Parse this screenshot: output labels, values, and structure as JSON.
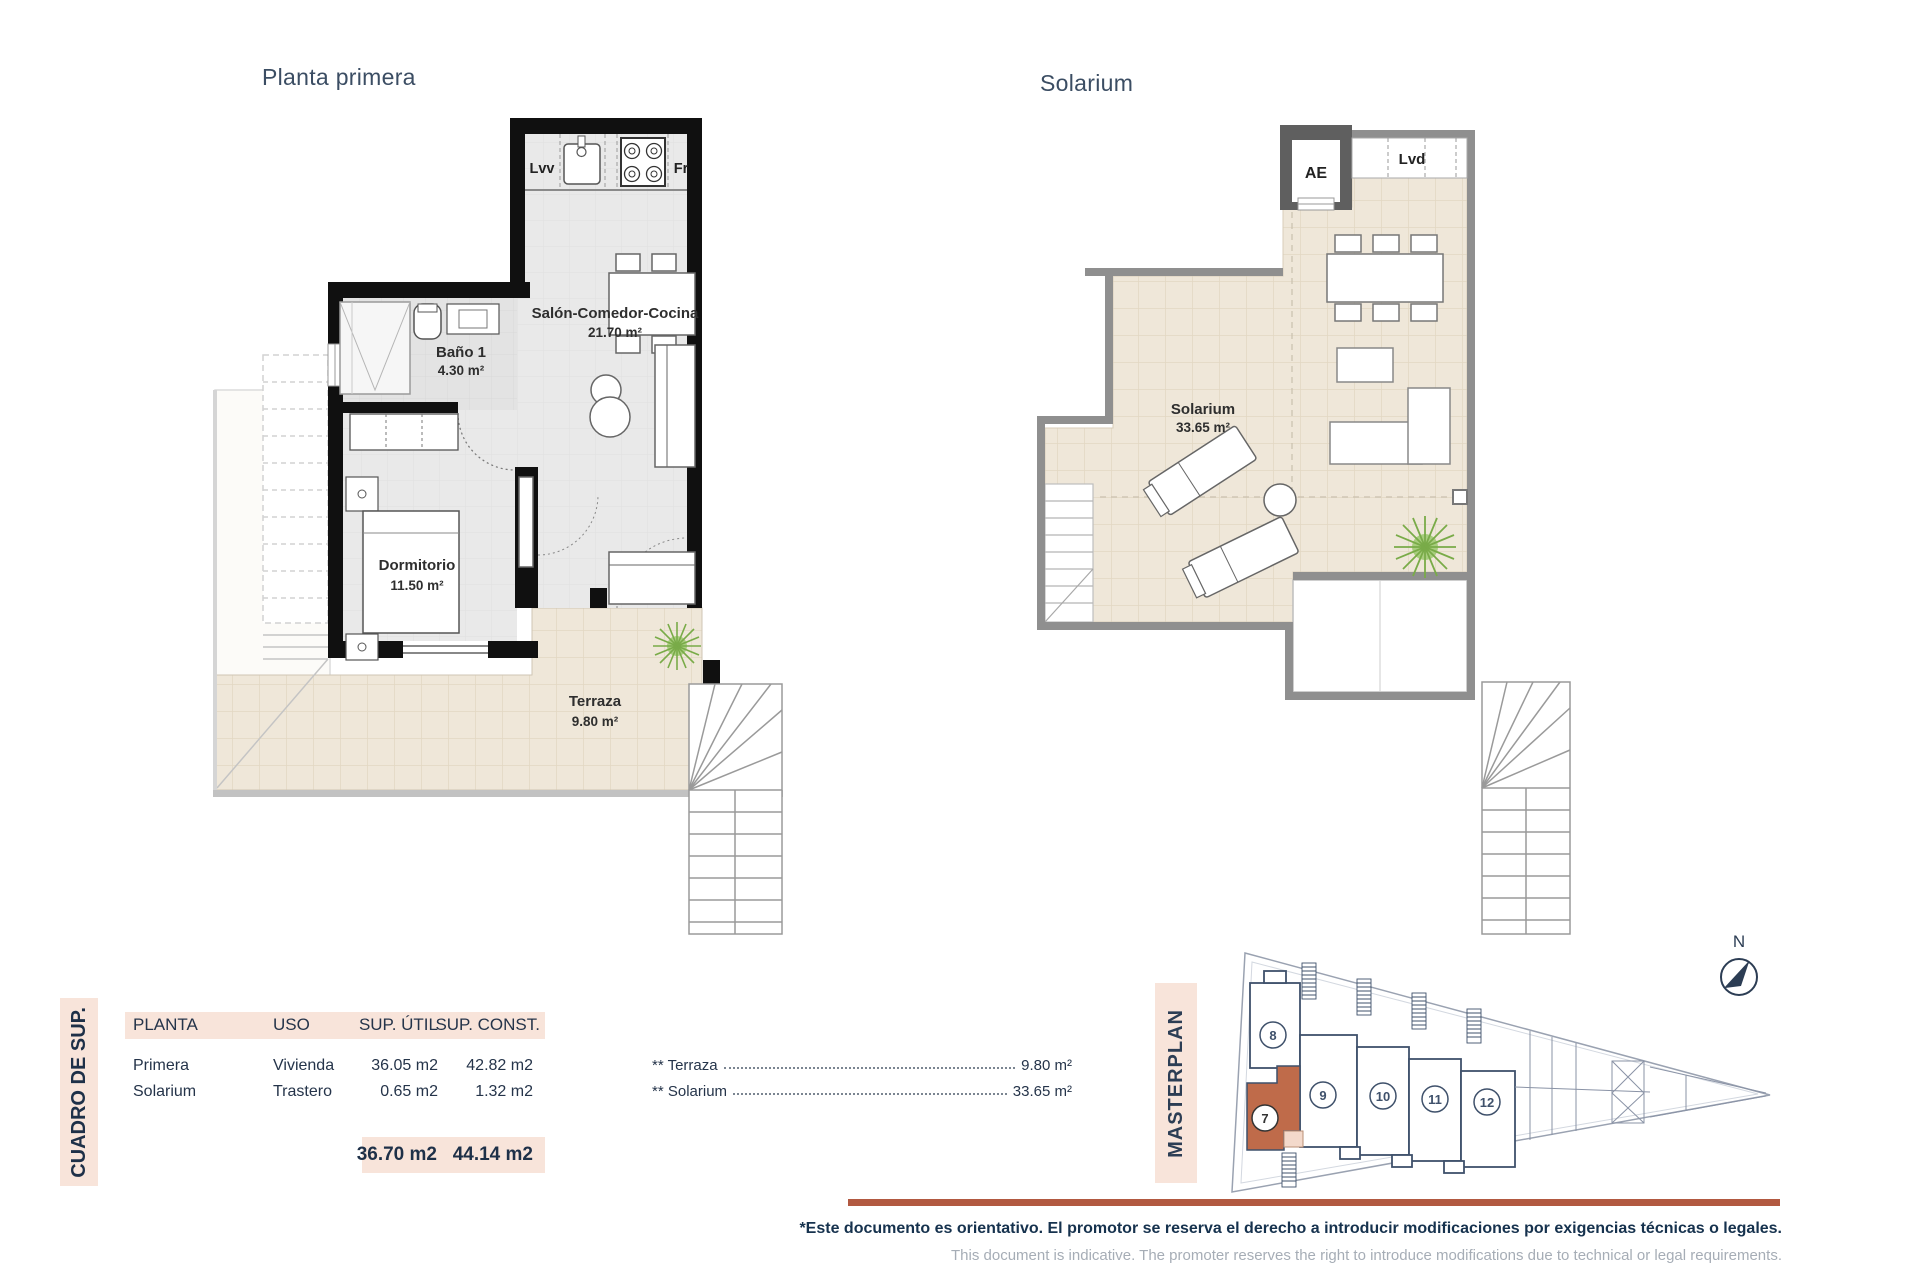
{
  "titles": {
    "plan1": "Planta primera",
    "plan2": "Solarium"
  },
  "plan1": {
    "kitchen": {
      "dishwasher": "Lvv",
      "fridge": "Fr"
    },
    "rooms": [
      {
        "name": "Baño 1",
        "area": "4.30 m²"
      },
      {
        "name": "Salón-Comedor-Cocina",
        "area": "21.70 m²"
      },
      {
        "name": "Dormitorio",
        "area": "11.50 m²"
      },
      {
        "name": "Terraza",
        "area": "9.80 m²"
      }
    ]
  },
  "plan2": {
    "aircon": "AE",
    "laundry": "Lvd",
    "rooms": [
      {
        "name": "Solarium",
        "area": "33.65 m²"
      }
    ]
  },
  "summary": {
    "side_title": "CUADRO DE SUP.",
    "headers": [
      "PLANTA",
      "USO",
      "SUP. ÚTIL",
      "SUP. CONST."
    ],
    "rows": [
      {
        "planta": "Primera",
        "uso": "Vivienda",
        "sup_util": "36.05 m2",
        "sup_const": "42.82 m2"
      },
      {
        "planta": "Solarium",
        "uso": "Trastero",
        "sup_util": "0.65 m2",
        "sup_const": "1.32 m2"
      }
    ],
    "totals": {
      "sup_util": "36.70 m2",
      "sup_const": "44.14 m2"
    },
    "annotations": [
      {
        "label": "** Terraza",
        "value": "9.80 m²"
      },
      {
        "label": "** Solarium",
        "value": "33.65 m²"
      }
    ]
  },
  "masterplan": {
    "side_title": "MASTERPLAN",
    "north_label": "N",
    "units": [
      "7",
      "8",
      "9",
      "10",
      "11",
      "12"
    ],
    "highlighted_unit": "7",
    "highlight_color": "#bf6b4a"
  },
  "footer": {
    "disclaimer_es": "*Este documento es orientativo. El promotor se reserva el derecho a introducir modificaciones por exigencias técnicas o legales.",
    "disclaimer_en": "This document is indicative. The promoter reserves the right to introduce modifications due to technical or legal requirements."
  },
  "colors": {
    "accent_pink": "#f8e4da",
    "accent_terracotta": "#b25941",
    "navy_text": "#25344a",
    "plan_title_text": "#3b4d63"
  }
}
